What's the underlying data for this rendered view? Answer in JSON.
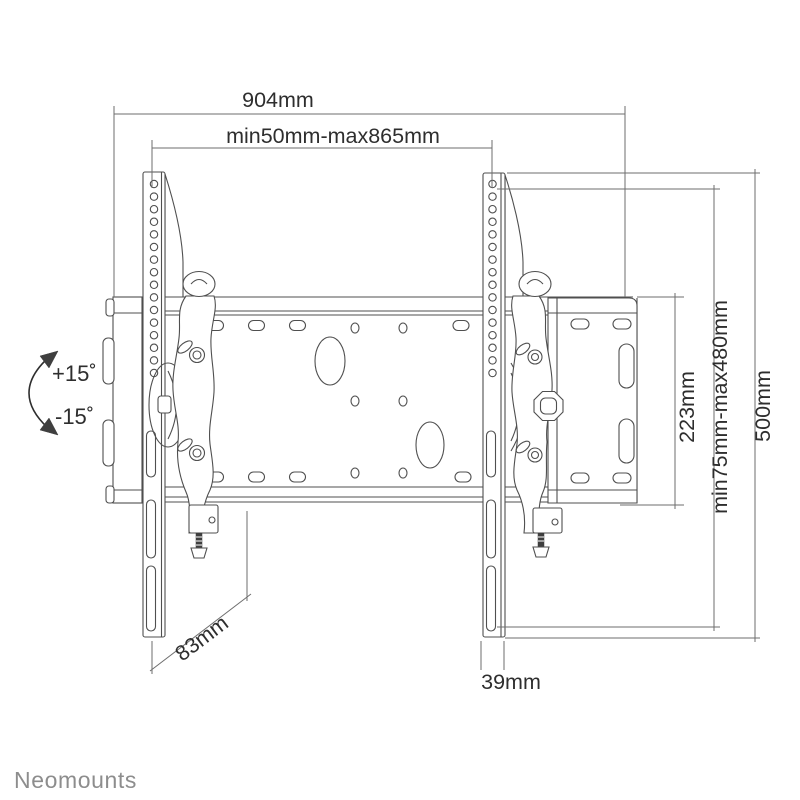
{
  "drawing": {
    "type": "tv-wall-mount-technical-drawing",
    "dimensions": {
      "total_width": "904mm",
      "mount_width_range": "min50mm-max865mm",
      "plate_height": "223mm",
      "mount_height_range": "min75mm-max480mm",
      "bracket_height": "500mm",
      "depth": "83mm",
      "bracket_width": "39mm"
    },
    "tilt": {
      "up_label": "+15˚",
      "down_label": "-15˚"
    },
    "icons": {
      "tilt_arrow": "curved-double-headed-arrow"
    },
    "colors": {
      "background": "#ffffff",
      "drawing_line": "#4f4f4f",
      "dimension_line": "#6e6e6e",
      "text": "#2e2e2e",
      "logo": "#8d8d8d"
    },
    "brand": "Neomounts"
  }
}
